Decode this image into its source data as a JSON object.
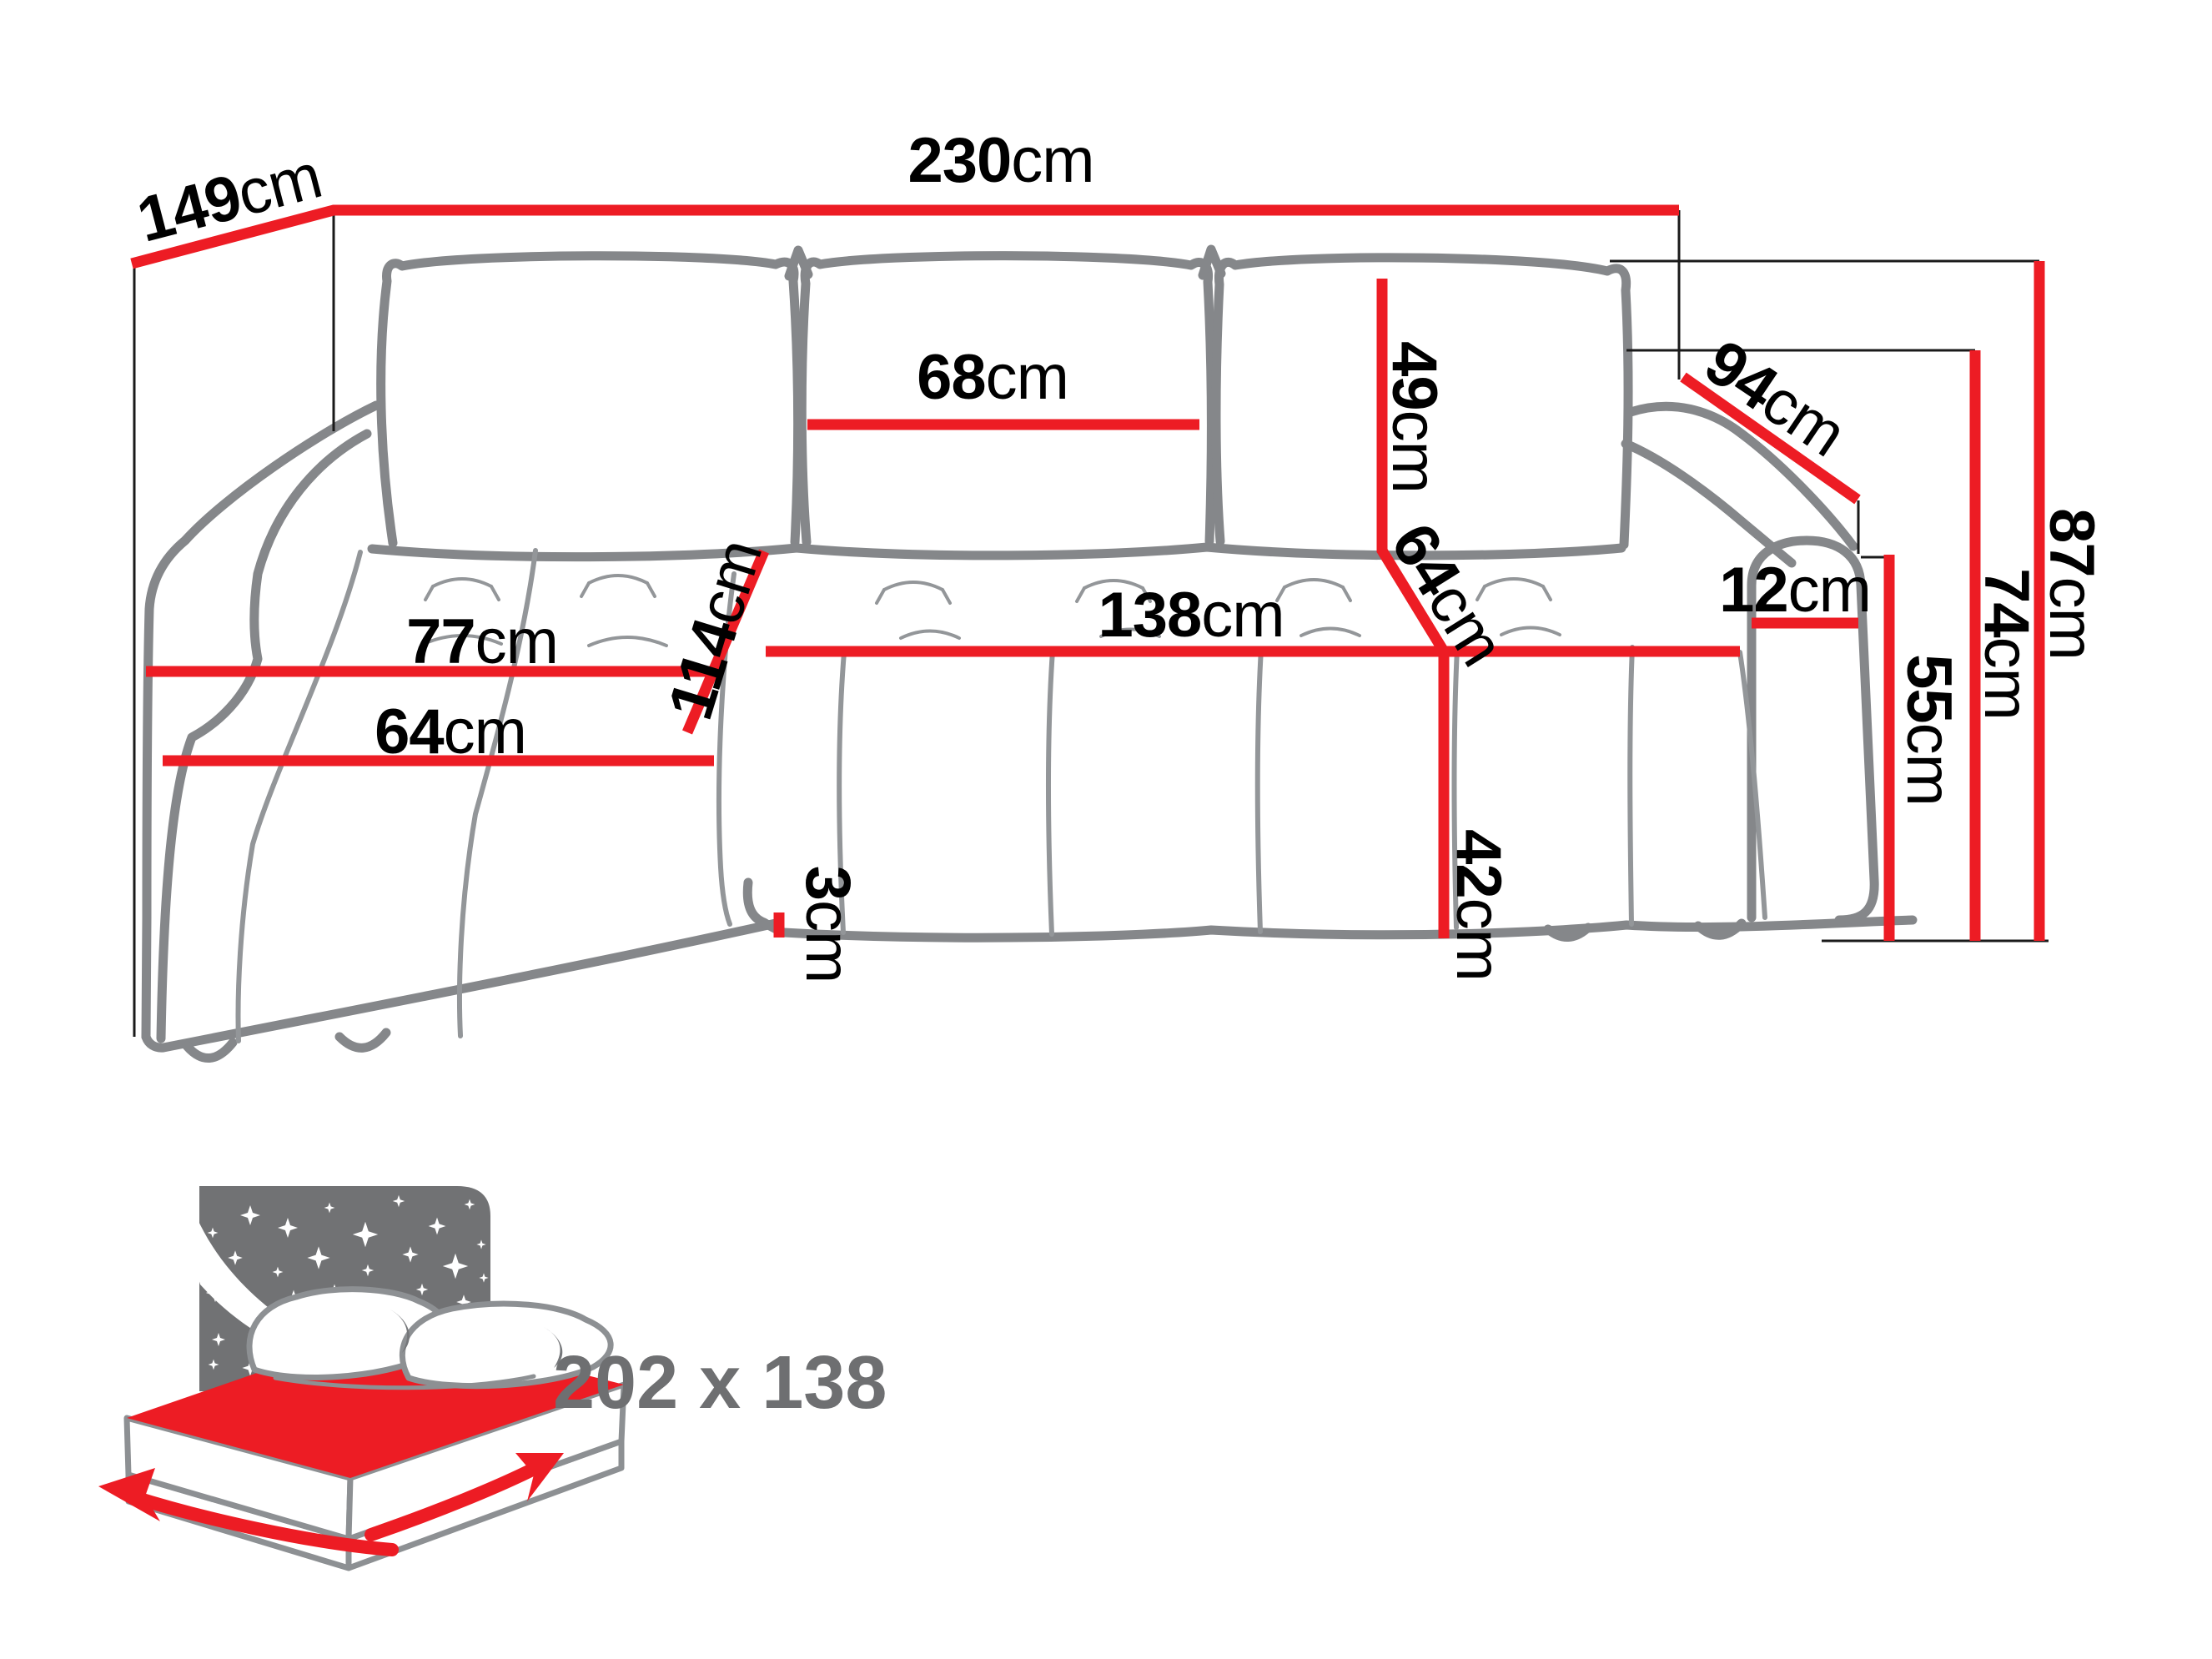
{
  "colors": {
    "red": "#ed1c24",
    "sofa": "#85878a",
    "seam": "#939699",
    "black": "#1a1a1a",
    "text": "#000000",
    "graytext": "#6e6f71",
    "panel": "#717274",
    "bg": "#ffffff"
  },
  "dims": {
    "d149": {
      "num": "149",
      "unit": "cm"
    },
    "d230": {
      "num": "230",
      "unit": "cm"
    },
    "d68": {
      "num": "68",
      "unit": "cm"
    },
    "d49": {
      "num": "49",
      "unit": "cm"
    },
    "d64diag": {
      "num": "64",
      "unit": "cm"
    },
    "d138": {
      "num": "138",
      "unit": "cm"
    },
    "d114": {
      "num": "114",
      "unit": "cm"
    },
    "d77": {
      "num": "77",
      "unit": "cm"
    },
    "d64left": {
      "num": "64",
      "unit": "cm"
    },
    "d42": {
      "num": "42",
      "unit": "cm"
    },
    "d3": {
      "num": "3",
      "unit": "cm"
    },
    "d94": {
      "num": "94",
      "unit": "cm"
    },
    "d12": {
      "num": "12",
      "unit": "cm"
    },
    "d55": {
      "num": "55",
      "unit": "cm"
    },
    "d74": {
      "num": "74",
      "unit": "cm"
    },
    "d87": {
      "num": "87",
      "unit": "cm"
    }
  },
  "bed": {
    "size_label": "202 x 138"
  }
}
